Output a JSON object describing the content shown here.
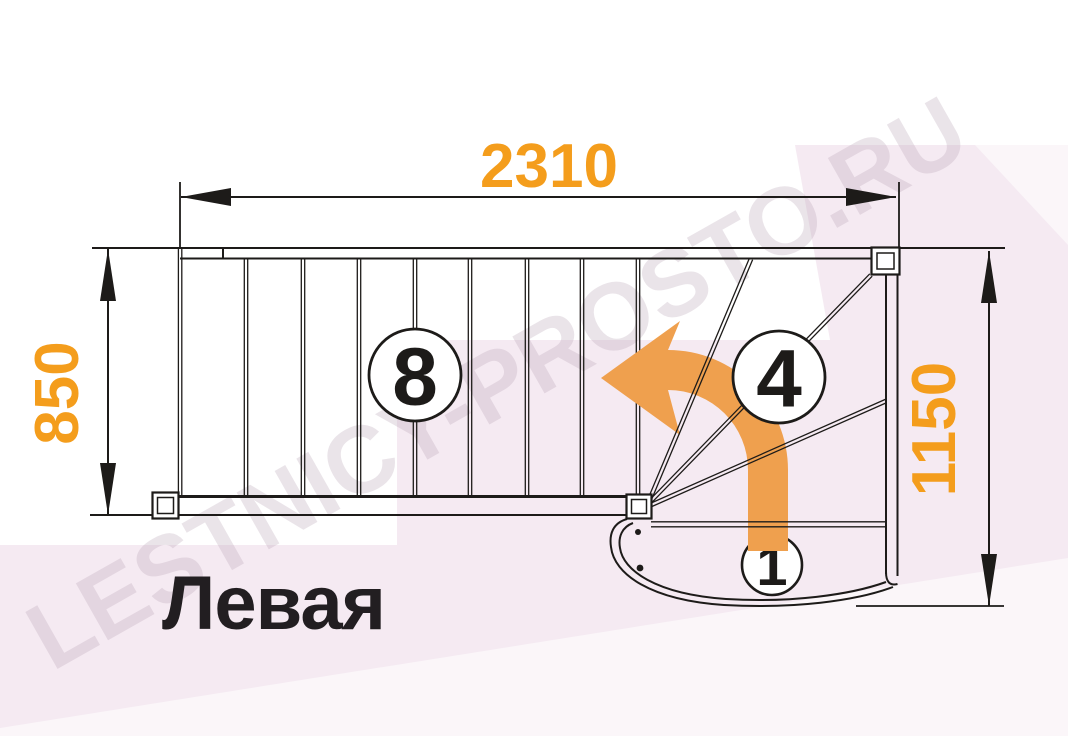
{
  "diagram": {
    "type": "staircase-floor-plan",
    "variant_label": "Левая",
    "watermark": "LESTNICY-PROSTO.RU",
    "dimensions": {
      "total_run": "2310",
      "flight_width": "850",
      "exit_width": "1150"
    },
    "steps": {
      "straight_flight_step": "8",
      "winder_step": "4",
      "first_step": "1"
    },
    "colors": {
      "dimension_text": "#F49D1C",
      "direction_arrow": "#EFA04E",
      "drawing_lines": "#1D1B19",
      "watermark_pink": "#F5E7F0"
    }
  }
}
